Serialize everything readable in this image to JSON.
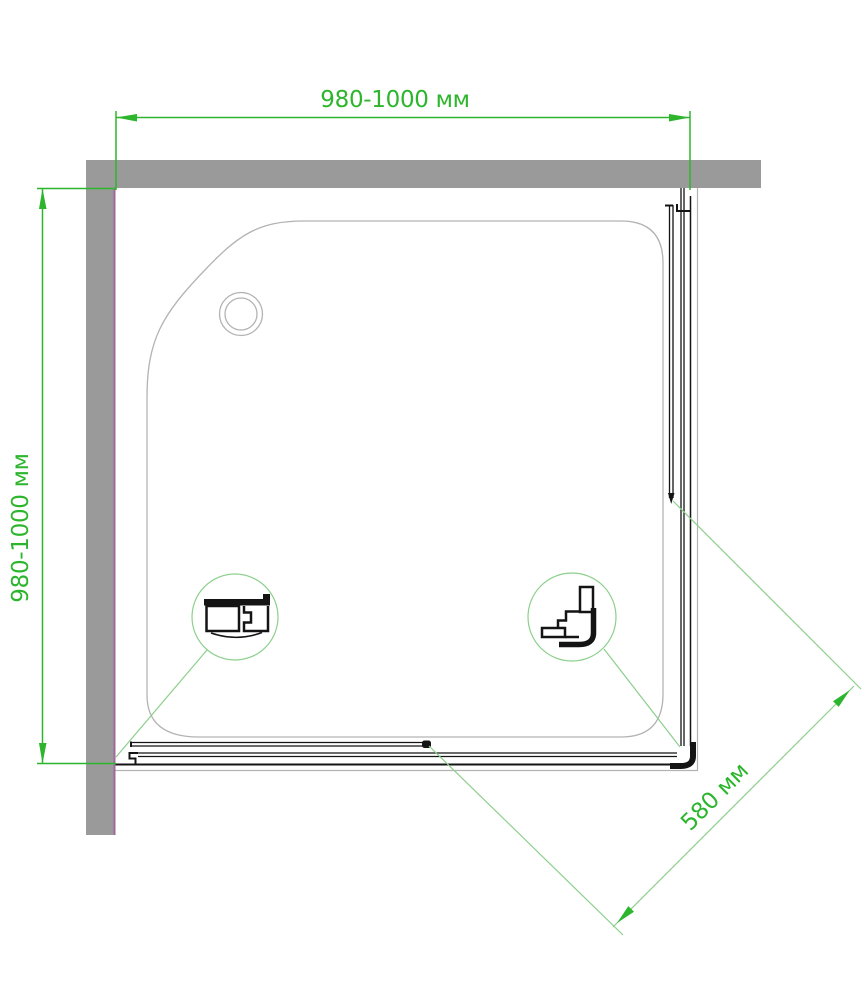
{
  "drawing": {
    "title": "shower-enclosure-top-view",
    "dimensions": {
      "top": "980-1000 мм",
      "left": "980-1000 мм",
      "diagonal": "580 мм"
    },
    "colors": {
      "dimension_green": "#2db52d",
      "leader_green": "#8ccf8c",
      "wall_gray": "#9a9a9a",
      "purple_accent": "#a0679a",
      "tray_outline": "#b3b3b3",
      "profile_black": "#141414"
    }
  }
}
